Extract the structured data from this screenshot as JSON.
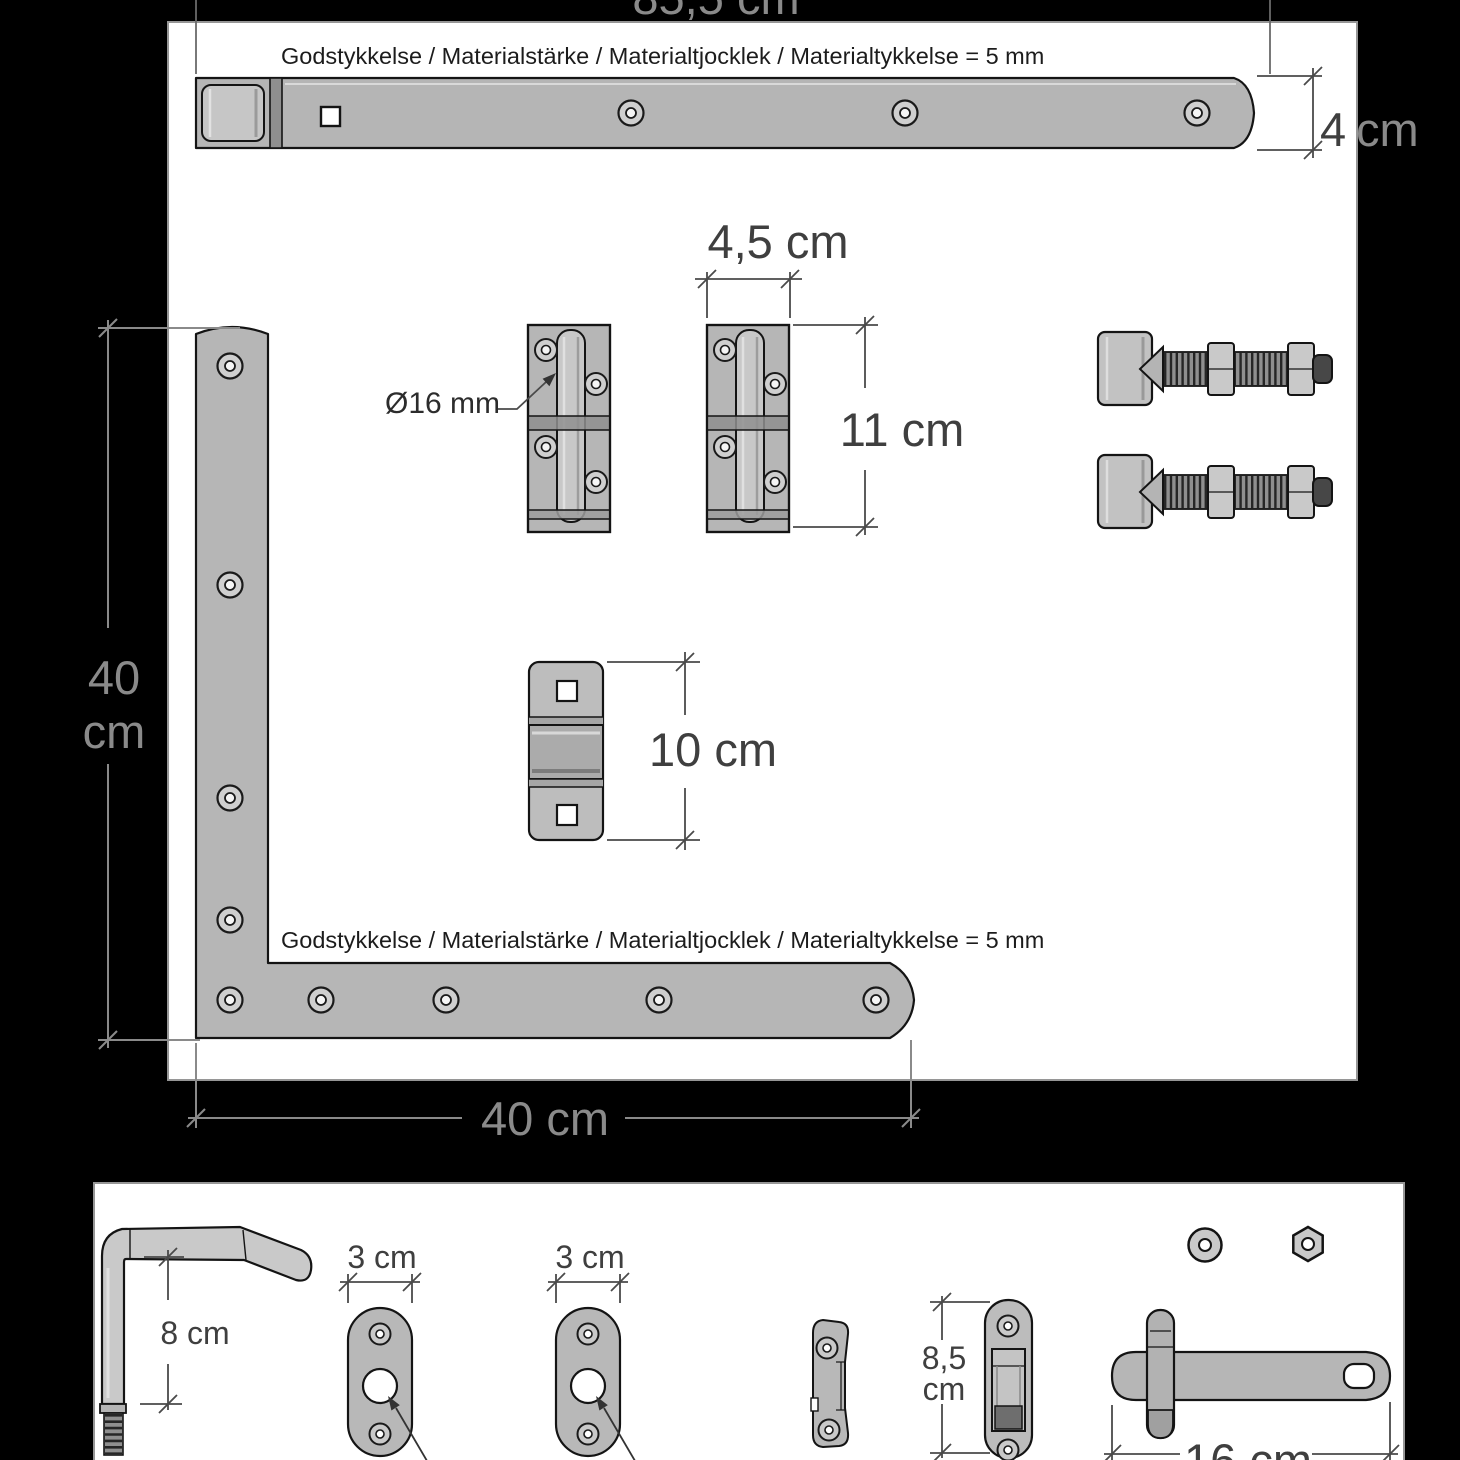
{
  "colors": {
    "background": "#000000",
    "panel": "#ffffff",
    "metal": "#b8b8b8",
    "metal_light": "#c9c9c9",
    "metal_dark": "#8f8f8f",
    "outline": "#141414",
    "dim_on_white": "#3f3f3f",
    "dim_on_black": "#8a8a8a"
  },
  "notes": {
    "material": "Godstykkelse / Materialstärke / Materialtjocklek / Materialtykkelse = 5 mm"
  },
  "dimensions": {
    "strap_length": "85,5 cm",
    "strap_width_value": "4",
    "strap_width_unit": "cm",
    "hinge_width": "4,5 cm",
    "hinge_height": "11 cm",
    "pin_diameter": "Ø16 mm",
    "keeper_height": "10 cm",
    "bracket_height_value": "40",
    "bracket_height_unit": "cm",
    "bracket_width": "40 cm",
    "pin_length": "8 cm",
    "plate_width_1": "3 cm",
    "plate_width_2": "3 cm",
    "latch_keeper_height_value": "8,5",
    "latch_keeper_height_unit": "cm",
    "latch_length": "16 cm"
  }
}
